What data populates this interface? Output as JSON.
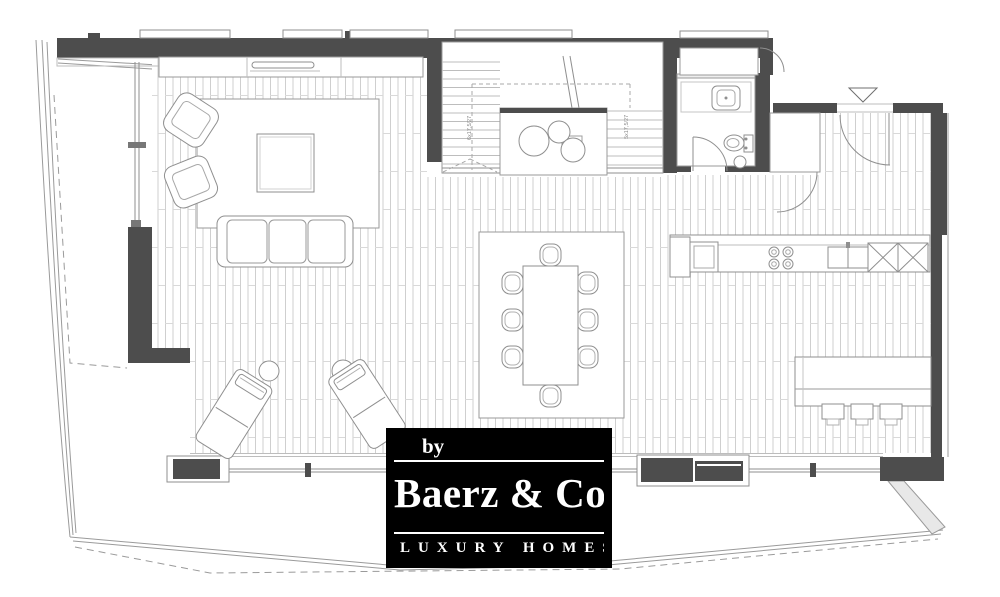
{
  "logo": {
    "prefix": "by",
    "name": "Baerz & Co",
    "tagline": "LUXURY HOMES",
    "background": "#000000",
    "text_color": "#ffffff"
  },
  "plan": {
    "stair_labels": {
      "left": "6x17,5/27",
      "right": "5x17,5/27"
    },
    "colors": {
      "wall": "#4d4d4d",
      "furniture_line": "#8f8f8f",
      "floor_plank_line": "#cfcfcf",
      "boundary_line": "#9a9a9a",
      "background": "#ffffff"
    }
  }
}
